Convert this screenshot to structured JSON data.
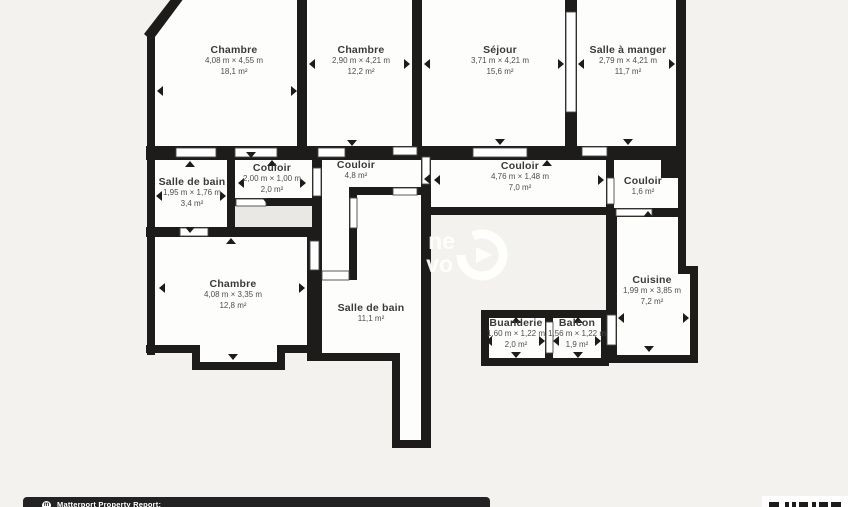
{
  "colors": {
    "background": "#f4f2ef",
    "wall": "#1d1c1a",
    "room_fill": "#fdfdfc",
    "closet_fill": "#eae8e4",
    "footer_bar": "#232323"
  },
  "plan": {
    "rooms": [
      {
        "id": "chambre-1",
        "name": "Chambre",
        "dims": "4,08 m × 4,55 m",
        "area": "18,1 m²",
        "cx": 234,
        "cy": 45
      },
      {
        "id": "chambre-2",
        "name": "Chambre",
        "dims": "2,90 m × 4,21 m",
        "area": "12,2 m²",
        "cx": 361,
        "cy": 45
      },
      {
        "id": "sejour",
        "name": "Séjour",
        "dims": "3,71 m × 4,21 m",
        "area": "15,6 m²",
        "cx": 500,
        "cy": 45
      },
      {
        "id": "salle-a-manger",
        "name": "Salle à manger",
        "dims": "2,79 m × 4,21 m",
        "area": "11,7 m²",
        "cx": 628,
        "cy": 45
      },
      {
        "id": "salle-de-bain-1",
        "name": "Salle de bain",
        "dims": "1,95 m × 1,76 m",
        "area": "3,4 m²",
        "cx": 192,
        "cy": 177
      },
      {
        "id": "couloir-petit",
        "name": "Couloir",
        "dims": "2,00 m × 1,00 m",
        "area": "2,0 m²",
        "cx": 272,
        "cy": 163
      },
      {
        "id": "couloir-48",
        "name": "Couloir",
        "dims": "",
        "area": "4,8 m²",
        "cx": 356,
        "cy": 160
      },
      {
        "id": "couloir-70",
        "name": "Couloir",
        "dims": "4,76 m × 1,48 m",
        "area": "7,0 m²",
        "cx": 520,
        "cy": 161
      },
      {
        "id": "couloir-16",
        "name": "Couloir",
        "dims": "",
        "area": "1,6 m²",
        "cx": 643,
        "cy": 176
      },
      {
        "id": "chambre-3",
        "name": "Chambre",
        "dims": "4,08 m × 3,35 m",
        "area": "12,8 m²",
        "cx": 233,
        "cy": 279
      },
      {
        "id": "salle-de-bain-2",
        "name": "Salle de bain",
        "dims": "",
        "area": "11,1 m²",
        "cx": 371,
        "cy": 303
      },
      {
        "id": "buanderie",
        "name": "Buanderie",
        "dims": "1,60 m × 1,22 m",
        "area": "2,0 m²",
        "cx": 516,
        "cy": 318
      },
      {
        "id": "balcon",
        "name": "Balcon",
        "dims": "1,56 m × 1,22 m",
        "area": "1,9 m²",
        "cx": 577,
        "cy": 318
      },
      {
        "id": "cuisine",
        "name": "Cuisine",
        "dims": "1,99 m × 3,85 m",
        "area": "7,2 m²",
        "cx": 652,
        "cy": 275
      }
    ]
  },
  "watermark": {
    "line1": "ne",
    "line2": "vo"
  },
  "footer": {
    "label": "Matterport Property Report:"
  }
}
